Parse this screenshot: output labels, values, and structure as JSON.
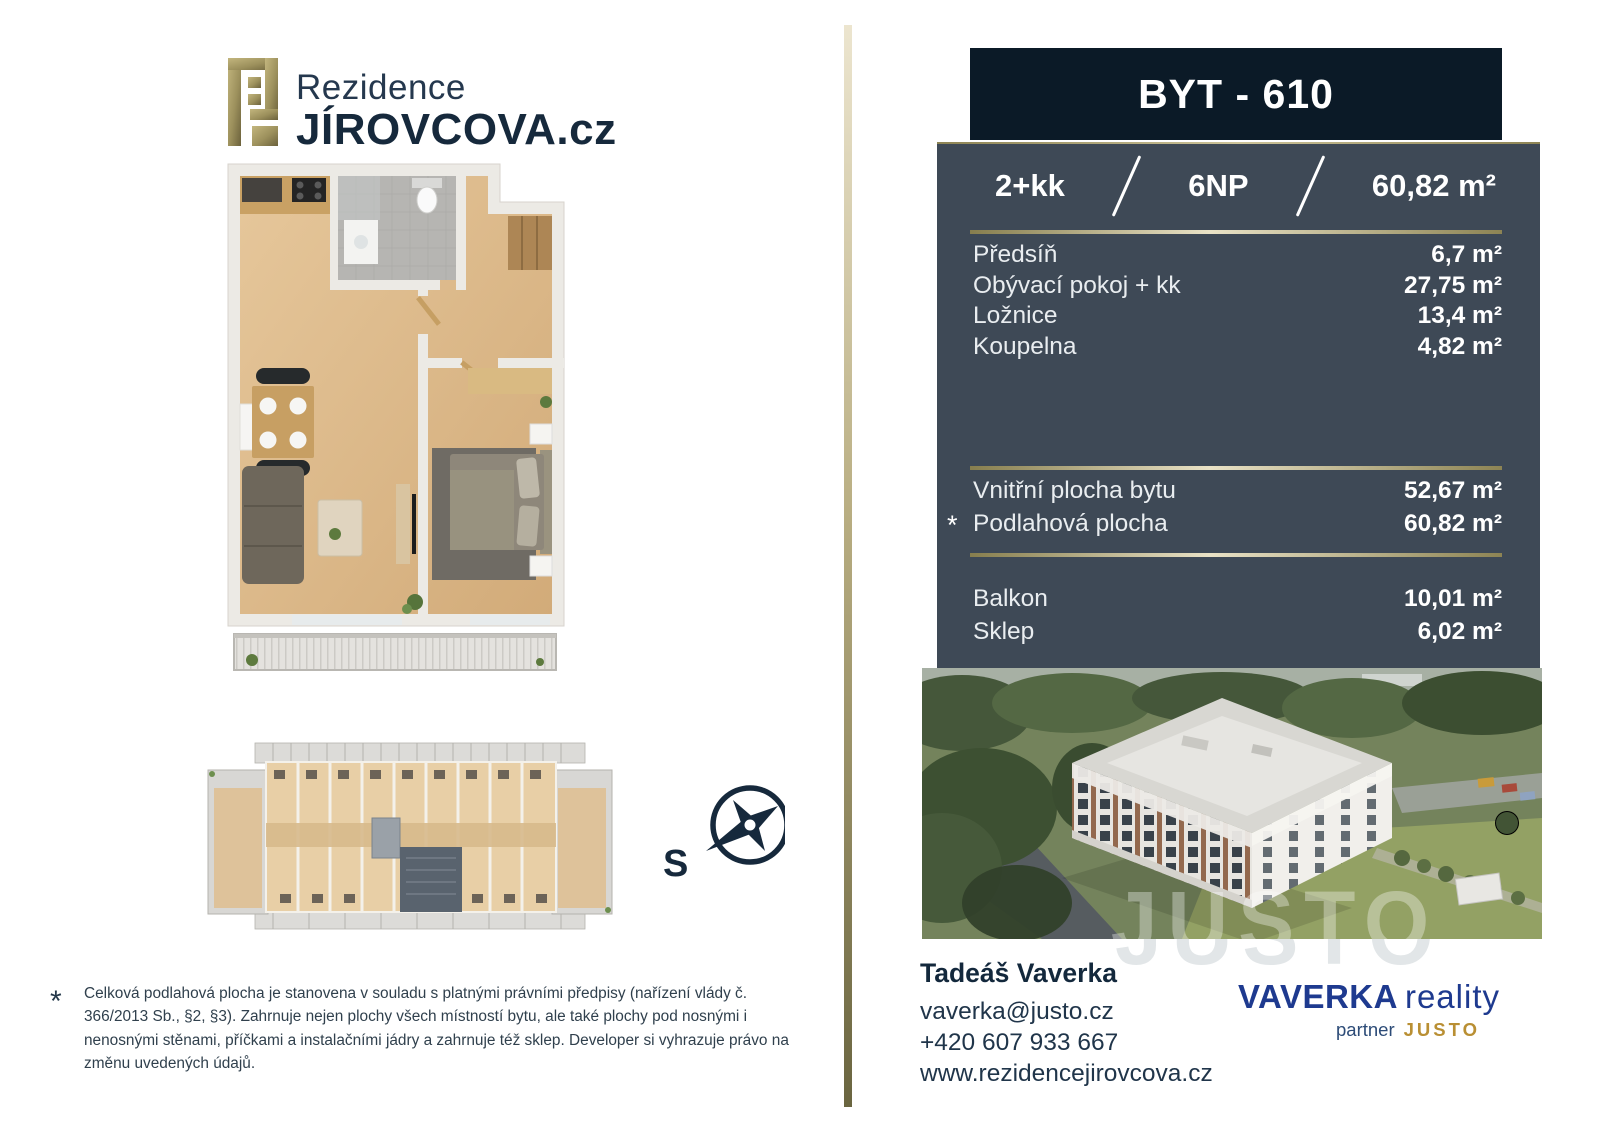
{
  "brand": {
    "line1": "Rezidence",
    "line2": "JÍROVCOVA.cz"
  },
  "unit": {
    "title": "BYT - 610",
    "layout": "2+kk",
    "floor": "6NP",
    "area": "60,82 m²",
    "rooms": [
      {
        "label": "Předsíň",
        "value": "6,7 m²"
      },
      {
        "label": "Obývací pokoj + kk",
        "value": "27,75 m²"
      },
      {
        "label": "Ložnice",
        "value": "13,4 m²"
      },
      {
        "label": "Koupelna",
        "value": "4,82 m²"
      }
    ],
    "totals": [
      {
        "marker": "",
        "label": "Vnitřní plocha bytu",
        "value": "52,67 m²"
      },
      {
        "marker": "*",
        "label": "Podlahová plocha",
        "value": "60,82 m²"
      }
    ],
    "extras": [
      {
        "label": "Balkon",
        "value": "10,01 m²"
      },
      {
        "label": "Sklep",
        "value": "6,02 m²"
      }
    ]
  },
  "compass": {
    "label": "S"
  },
  "photo": {
    "watermark": "JUSTO"
  },
  "contact": {
    "name": "Tadeáš Vaverka",
    "email": "vaverka@justo.cz",
    "phone": "+420 607 933 667",
    "website": "www.rezidencejirovcova.cz"
  },
  "agency": {
    "name": "VAVERKA",
    "suffix": "reality",
    "partner_label": "partner",
    "partner_name": "JUSTO"
  },
  "footnote": {
    "marker": "*",
    "text": "Celková podlahová plocha je stanovena v souladu s platnými právními předpisy (nařízení vlády č. 366/2013 Sb., §2, §3). Zahrnuje nejen plochy všech místností bytu, ale také plochy pod nosnými i nenosnými stěnami, příčkami a instalačními jádry a zahrnuje též sklep. Developer si vyhrazuje právo na změnu uvedených údajů.",
    "colors_note": ""
  },
  "colors": {
    "navy_bar": "#0b1a27",
    "slate_panel": "#3e4956",
    "gold_accent": "#b9ae82",
    "brand_navy": "#16293c",
    "agency_blue": "#1e3a8f",
    "justo_gold": "#b98f33"
  }
}
